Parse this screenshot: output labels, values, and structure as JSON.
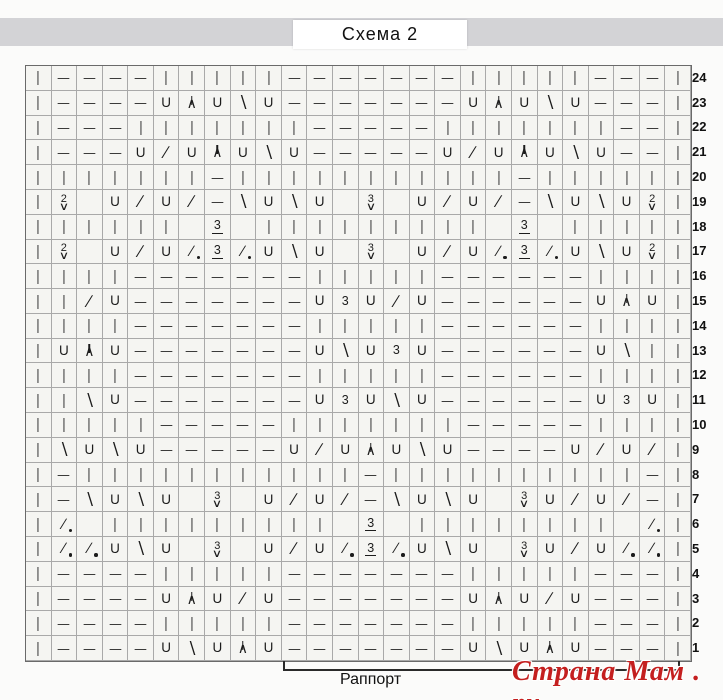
{
  "header": {
    "title": "Схема 2"
  },
  "chart": {
    "type": "knitting-chart",
    "columns": 26,
    "row_numbers": [
      24,
      23,
      22,
      21,
      20,
      19,
      18,
      17,
      16,
      15,
      14,
      13,
      12,
      11,
      10,
      9,
      8,
      7,
      6,
      5,
      4,
      3,
      2,
      1
    ],
    "symbols": {
      "k": {
        "glyph": "|",
        "name": "knit-stitch"
      },
      "p": {
        "glyph": "—",
        "name": "purl-stitch"
      },
      "yo": {
        "glyph": "U",
        "name": "yarn-over"
      },
      "k2t": {
        "glyph": "∕",
        "name": "k2tog-right-decrease"
      },
      "ssk": {
        "glyph": "∖",
        "name": "left-decrease"
      },
      "cdd": {
        "glyph": "∧",
        "name": "central-double-decrease"
      },
      "p2t": {
        "glyph": "∕",
        "name": "decrease-with-dot"
      },
      "cl3": {
        "glyph": "3",
        "name": "cluster-3-underlined"
      },
      "k3": {
        "glyph": "3",
        "name": "work-3-times"
      },
      "w2": {
        "glyph": "2",
        "under": "∨",
        "name": "elongated-2-wraps"
      },
      "w3": {
        "glyph": "3",
        "under": "∨",
        "name": "elongated-3-wraps"
      }
    },
    "rows": [
      [
        "k",
        "p",
        "p",
        "p",
        "p",
        "k",
        "k",
        "k",
        "k",
        "k",
        "p",
        "p",
        "p",
        "p",
        "p",
        "p",
        "p",
        "k",
        "k",
        "k",
        "k",
        "k",
        "p",
        "p",
        "p",
        "k"
      ],
      [
        "k",
        "p",
        "p",
        "p",
        "p",
        "yo",
        "cdd",
        "yo",
        "ssk",
        "yo",
        "p",
        "p",
        "p",
        "p",
        "p",
        "p",
        "p",
        "yo",
        "cdd",
        "yo",
        "ssk",
        "yo",
        "p",
        "p",
        "p",
        "k"
      ],
      [
        "k",
        "p",
        "p",
        "p",
        "k",
        "k",
        "k",
        "k",
        "k",
        "k",
        "k",
        "p",
        "p",
        "p",
        "p",
        "p",
        "k",
        "k",
        "k",
        "k",
        "k",
        "k",
        "k",
        "p",
        "p",
        "k"
      ],
      [
        "k",
        "p",
        "p",
        "p",
        "yo",
        "k2t",
        "yo",
        "cdd",
        "yo",
        "ssk",
        "yo",
        "p",
        "p",
        "p",
        "p",
        "p",
        "yo",
        "k2t",
        "yo",
        "cdd",
        "yo",
        "ssk",
        "yo",
        "p",
        "p",
        "k"
      ],
      [
        "k",
        "k",
        "k",
        "k",
        "k",
        "k",
        "k",
        "p",
        "k",
        "k",
        "k",
        "k",
        "k",
        "k",
        "k",
        "k",
        "k",
        "k",
        "k",
        "p",
        "k",
        "k",
        "k",
        "k",
        "k",
        "k"
      ],
      [
        "k",
        "w2",
        "",
        "yo",
        "k2t",
        "yo",
        "k2t",
        "p",
        "ssk",
        "yo",
        "ssk",
        "yo",
        "",
        "w3",
        "",
        "yo",
        "k2t",
        "yo",
        "k2t",
        "p",
        "ssk",
        "yo",
        "ssk",
        "yo",
        "w2",
        "k"
      ],
      [
        "k",
        "k",
        "k",
        "k",
        "k",
        "k",
        "",
        "cl3",
        "",
        "k",
        "k",
        "k",
        "k",
        "k",
        "k",
        "k",
        "k",
        "k",
        "",
        "cl3",
        "",
        "k",
        "k",
        "k",
        "k",
        "k"
      ],
      [
        "k",
        "w2",
        "",
        "yo",
        "k2t",
        "yo",
        "p2t",
        "cl3",
        "p2t",
        "yo",
        "ssk",
        "yo",
        "",
        "w3",
        "",
        "yo",
        "k2t",
        "yo",
        "p2t",
        "cl3",
        "p2t",
        "yo",
        "ssk",
        "yo",
        "w2",
        "k"
      ],
      [
        "k",
        "k",
        "k",
        "k",
        "p",
        "p",
        "p",
        "p",
        "p",
        "p",
        "p",
        "k",
        "k",
        "k",
        "k",
        "k",
        "p",
        "p",
        "p",
        "p",
        "p",
        "p",
        "k",
        "k",
        "k",
        "k"
      ],
      [
        "k",
        "k",
        "k2t",
        "yo",
        "p",
        "p",
        "p",
        "p",
        "p",
        "p",
        "p",
        "yo",
        "k3",
        "yo",
        "k2t",
        "yo",
        "p",
        "p",
        "p",
        "p",
        "p",
        "p",
        "yo",
        "cdd",
        "yo",
        "k"
      ],
      [
        "k",
        "k",
        "k",
        "k",
        "p",
        "p",
        "p",
        "p",
        "p",
        "p",
        "p",
        "k",
        "k",
        "k",
        "k",
        "k",
        "p",
        "p",
        "p",
        "p",
        "p",
        "p",
        "k",
        "k",
        "k",
        "k"
      ],
      [
        "k",
        "yo",
        "cdd",
        "yo",
        "p",
        "p",
        "p",
        "p",
        "p",
        "p",
        "p",
        "yo",
        "ssk",
        "yo",
        "k3",
        "yo",
        "p",
        "p",
        "p",
        "p",
        "p",
        "p",
        "yo",
        "ssk",
        "k",
        "k"
      ],
      [
        "k",
        "k",
        "k",
        "k",
        "p",
        "p",
        "p",
        "p",
        "p",
        "p",
        "p",
        "k",
        "k",
        "k",
        "k",
        "k",
        "p",
        "p",
        "p",
        "p",
        "p",
        "p",
        "k",
        "k",
        "k",
        "k"
      ],
      [
        "k",
        "k",
        "ssk",
        "yo",
        "p",
        "p",
        "p",
        "p",
        "p",
        "p",
        "p",
        "yo",
        "k3",
        "yo",
        "ssk",
        "yo",
        "p",
        "p",
        "p",
        "p",
        "p",
        "p",
        "yo",
        "k3",
        "yo",
        "k"
      ],
      [
        "k",
        "k",
        "k",
        "k",
        "k",
        "p",
        "p",
        "p",
        "p",
        "p",
        "k",
        "k",
        "k",
        "k",
        "k",
        "k",
        "k",
        "p",
        "p",
        "p",
        "p",
        "p",
        "k",
        "k",
        "k",
        "k"
      ],
      [
        "k",
        "ssk",
        "yo",
        "ssk",
        "yo",
        "p",
        "p",
        "p",
        "p",
        "p",
        "yo",
        "k2t",
        "yo",
        "cdd",
        "yo",
        "ssk",
        "yo",
        "p",
        "p",
        "p",
        "p",
        "yo",
        "k2t",
        "yo",
        "k2t",
        "k"
      ],
      [
        "k",
        "p",
        "k",
        "k",
        "k",
        "k",
        "k",
        "k",
        "k",
        "k",
        "k",
        "k",
        "k",
        "p",
        "k",
        "k",
        "k",
        "k",
        "k",
        "k",
        "k",
        "k",
        "k",
        "k",
        "p",
        "k"
      ],
      [
        "k",
        "p",
        "ssk",
        "yo",
        "ssk",
        "yo",
        "",
        "w3",
        "",
        "yo",
        "k2t",
        "yo",
        "k2t",
        "p",
        "ssk",
        "yo",
        "ssk",
        "yo",
        "",
        "w3",
        "yo",
        "k2t",
        "yo",
        "k2t",
        "p",
        "k"
      ],
      [
        "k",
        "p2t",
        "",
        "k",
        "k",
        "k",
        "k",
        "k",
        "k",
        "k",
        "k",
        "k",
        "",
        "cl3",
        "",
        "k",
        "k",
        "k",
        "k",
        "k",
        "k",
        "k",
        "k",
        "",
        "p2t",
        "k"
      ],
      [
        "k",
        "p2t",
        "p2t",
        "yo",
        "ssk",
        "yo",
        "",
        "w3",
        "",
        "yo",
        "k2t",
        "yo",
        "p2t",
        "cl3",
        "p2t",
        "yo",
        "ssk",
        "yo",
        "",
        "w3",
        "yo",
        "k2t",
        "yo",
        "p2t",
        "p2t",
        "k"
      ],
      [
        "k",
        "p",
        "p",
        "p",
        "p",
        "k",
        "k",
        "k",
        "k",
        "k",
        "p",
        "p",
        "p",
        "p",
        "p",
        "p",
        "p",
        "k",
        "k",
        "k",
        "k",
        "k",
        "p",
        "p",
        "p",
        "k"
      ],
      [
        "k",
        "p",
        "p",
        "p",
        "p",
        "yo",
        "cdd",
        "yo",
        "k2t",
        "yo",
        "p",
        "p",
        "p",
        "p",
        "p",
        "p",
        "p",
        "yo",
        "cdd",
        "yo",
        "k2t",
        "yo",
        "p",
        "p",
        "p",
        "k"
      ],
      [
        "k",
        "p",
        "p",
        "p",
        "p",
        "k",
        "k",
        "k",
        "k",
        "k",
        "p",
        "p",
        "p",
        "p",
        "p",
        "p",
        "p",
        "k",
        "k",
        "k",
        "k",
        "k",
        "p",
        "p",
        "p",
        "k"
      ],
      [
        "k",
        "p",
        "p",
        "p",
        "p",
        "yo",
        "ssk",
        "yo",
        "cdd",
        "yo",
        "p",
        "p",
        "p",
        "p",
        "p",
        "p",
        "p",
        "yo",
        "ssk",
        "yo",
        "cdd",
        "yo",
        "p",
        "p",
        "p",
        "k"
      ]
    ]
  },
  "footer": {
    "repeat_label": "Раппорт",
    "watermark": "Страна Мам . ру"
  },
  "colors": {
    "band": "#d3d3d6",
    "grid_line": "#a9a9a9",
    "symbol": "#1c1c1c",
    "watermark": "#c41f1f"
  }
}
